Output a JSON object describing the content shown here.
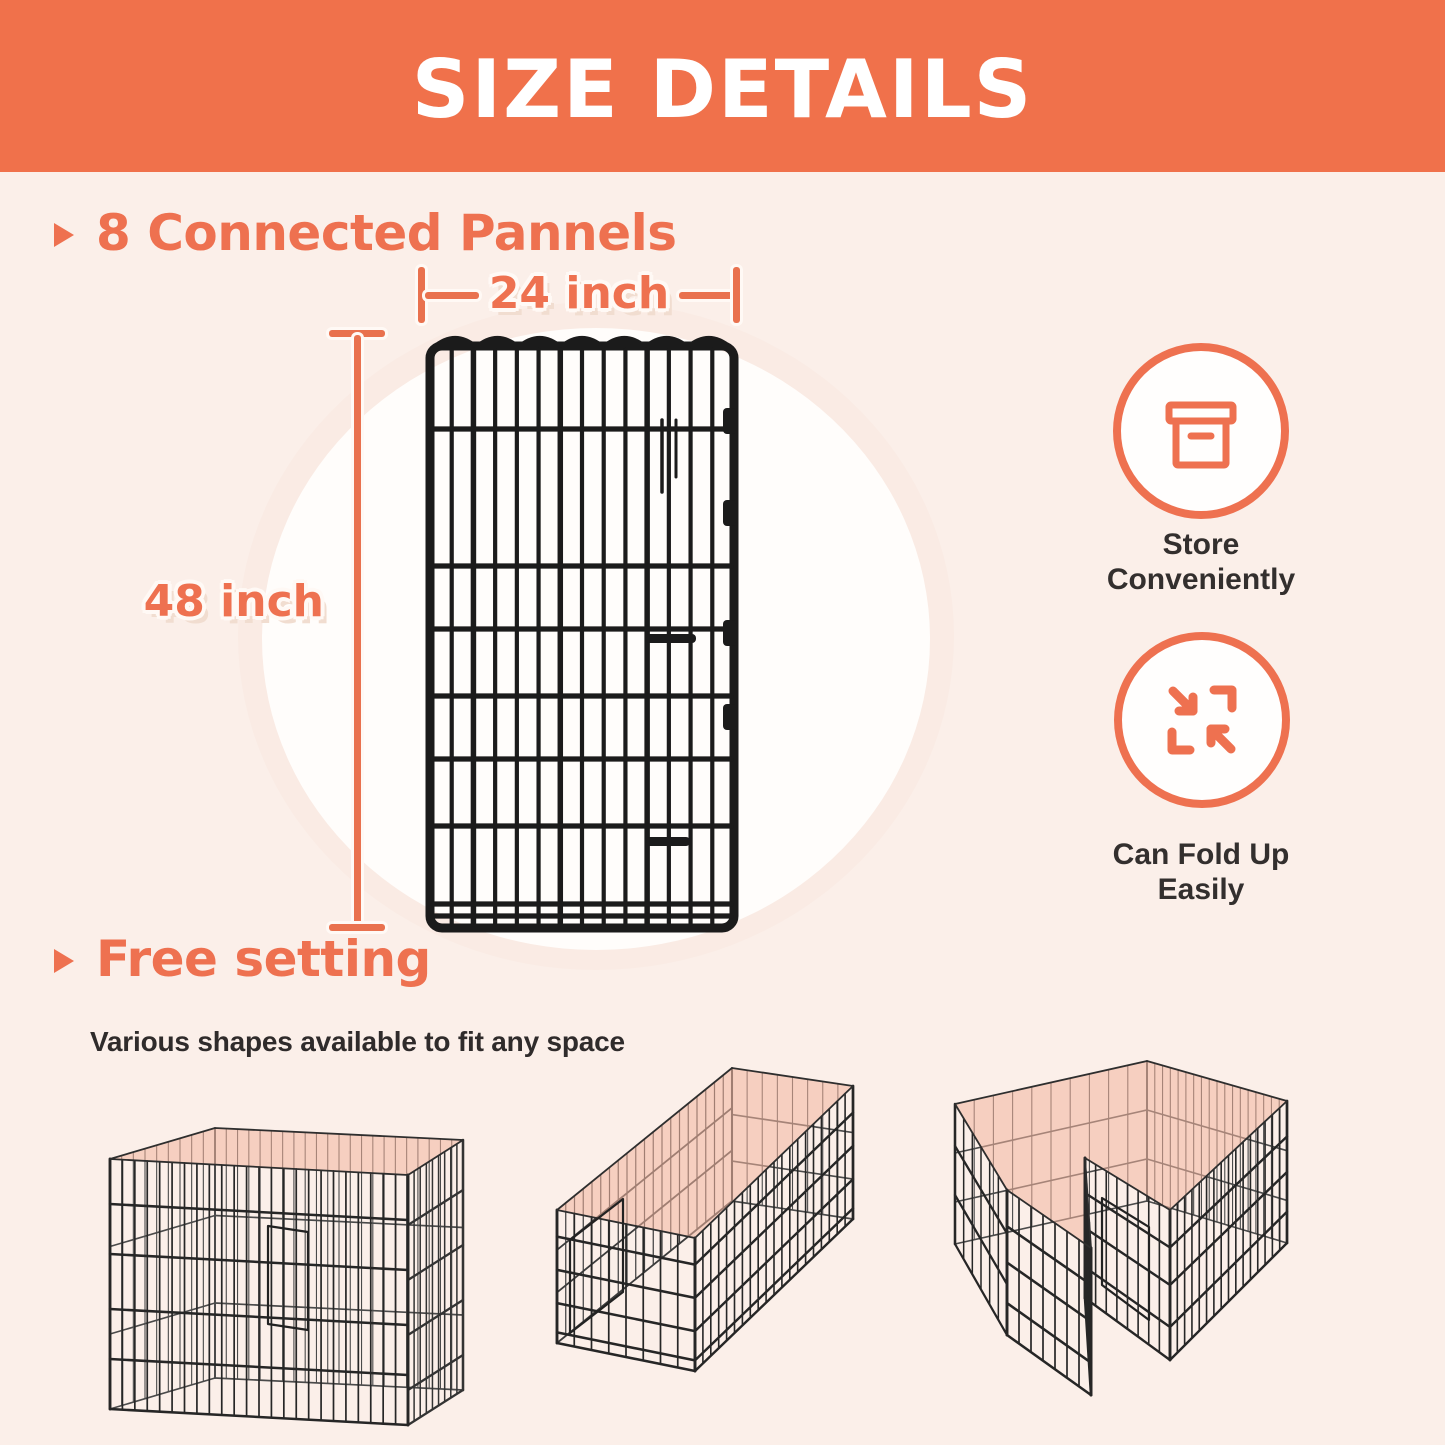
{
  "banner": {
    "title": "SIZE DETAILS"
  },
  "panel_section": {
    "heading": "8 Connected Pannels",
    "width_label": "24 inch",
    "height_label": "48 inch"
  },
  "features": [
    {
      "icon": "storage-box-icon",
      "label": "Store Conveniently"
    },
    {
      "icon": "fold-arrows-icon",
      "label": "Can Fold Up Easily"
    }
  ],
  "free_setting_section": {
    "heading": "Free setting",
    "subtitle": "Various shapes available to fit any space"
  },
  "illustrations": {
    "panel": "wire-panel-front",
    "configs": [
      "square-playpen",
      "long-rectangle-playpen",
      "l-shape-playpen"
    ]
  },
  "colors": {
    "banner_bg": "#F0714B",
    "accent_text": "#EE7150",
    "dim_line": "#E9714E",
    "background": "#FBEFE9",
    "dark_text": "#2F2B2B",
    "open_top_fill": "#F2B49E",
    "wire": "#1B1B1B",
    "white_glow": "#FFFDFB"
  }
}
